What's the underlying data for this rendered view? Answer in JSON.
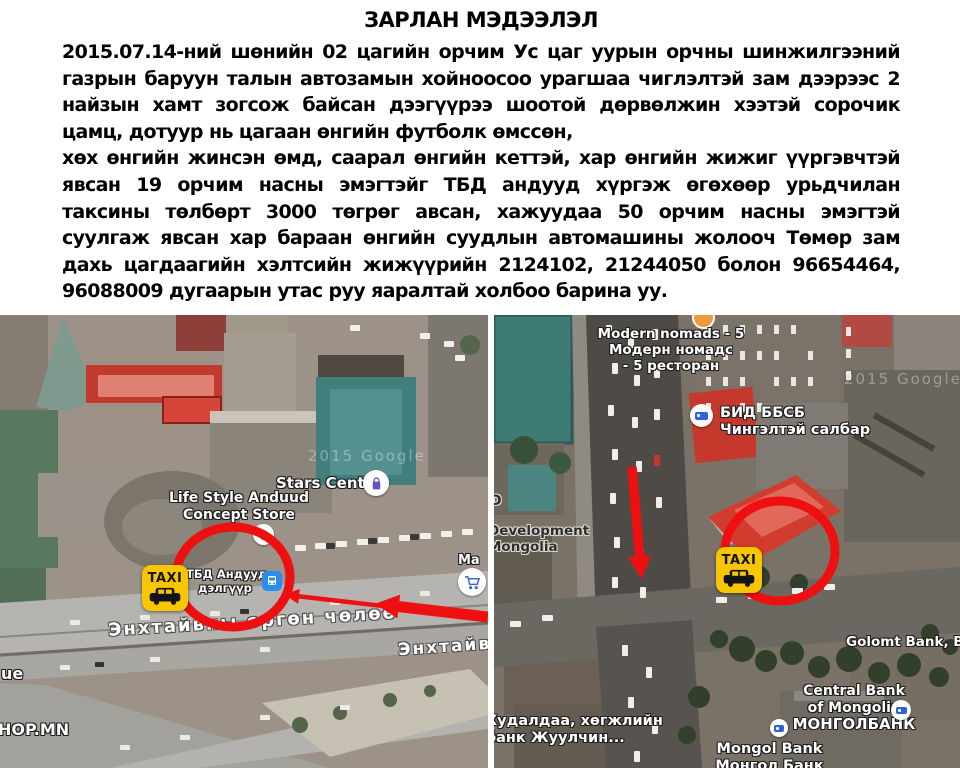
{
  "colors": {
    "annotation_red": "#ee1010",
    "taxi_yellow": "#f7c600",
    "divider": "#ffffff"
  },
  "announcement": {
    "title": "ЗАРЛАН МЭДЭЭЛЭЛ",
    "paragraphs": [
      "2015.07.14-ний шөнийн 02 цагийн орчим Ус цаг уурын орчны шинжилгээний газрын баруун талын автозамын хойноосоо урагшаа чиглэлтэй зам дээрээс 2 найзын хамт зогсож байсан дээгүүрээ шоотой дөрвөлжин хээтэй сорочик цамц, дотуур нь цагаан өнгийн футболк өмссөн,",
      "хөх өнгийн жинсэн өмд, саарал өнгийн кеттэй, хар өнгийн жижиг үүргэвчтэй явсан 19 орчим насны эмэгтэйг ТБД андууд хүргэж өгөхөөр урьдчилан таксины төлбөрт 3000 төгрөг авсан, хажуудаа 50 орчим насны эмэгтэй суулгаж явсан хар бараан өнгийн суудлын автомашины жолооч Төмөр зам дахь цагдаагийн хэлтсийн жижүүрийн 2124102, 21244050 болон 96654464, 96088009 дугаарын утас руу яаралтай холбоо барина уу."
    ]
  },
  "maps": {
    "left": {
      "watermark": "2015 Google",
      "labels": {
        "stars_center": "Stars Center",
        "lifestyle1": "Life Style Anduud",
        "lifestyle2": "Concept Store",
        "tbd1": "ТБД Андууд",
        "tbd2": "дэлгүүр",
        "taxi": "TAXI",
        "street": "Энхтайвны өргөн чөлөө",
        "street_partial": "Энхтайв",
        "avenue_fragment": "ue",
        "shop_fragment": "HOP.MN",
        "ma_fragment": "Ma"
      }
    },
    "right": {
      "watermark": "2015 Google",
      "labels": {
        "modern1": "Modern nomads - 5",
        "modern2": "Модерн номадс",
        "modern3": "- 5 ресторан",
        "bid1": "БИД ББСБ",
        "bid2": "Чингэлтэй салбар",
        "dev1": "Development",
        "dev2": "Mongolia",
        "dev_fragment": "D",
        "golomt": "Golomt Bank, Branc",
        "central1": "Central Bank",
        "central2": "of Mongolia",
        "central3": "МОНГОЛБАНК",
        "mongol1": "Mongol Bank",
        "mongol2": "Монгол Банк",
        "tdb1": "Худалдаа, хөгжлийн",
        "tdb2": "банк Жуулчин...",
        "taxi": "TAXI"
      }
    }
  }
}
